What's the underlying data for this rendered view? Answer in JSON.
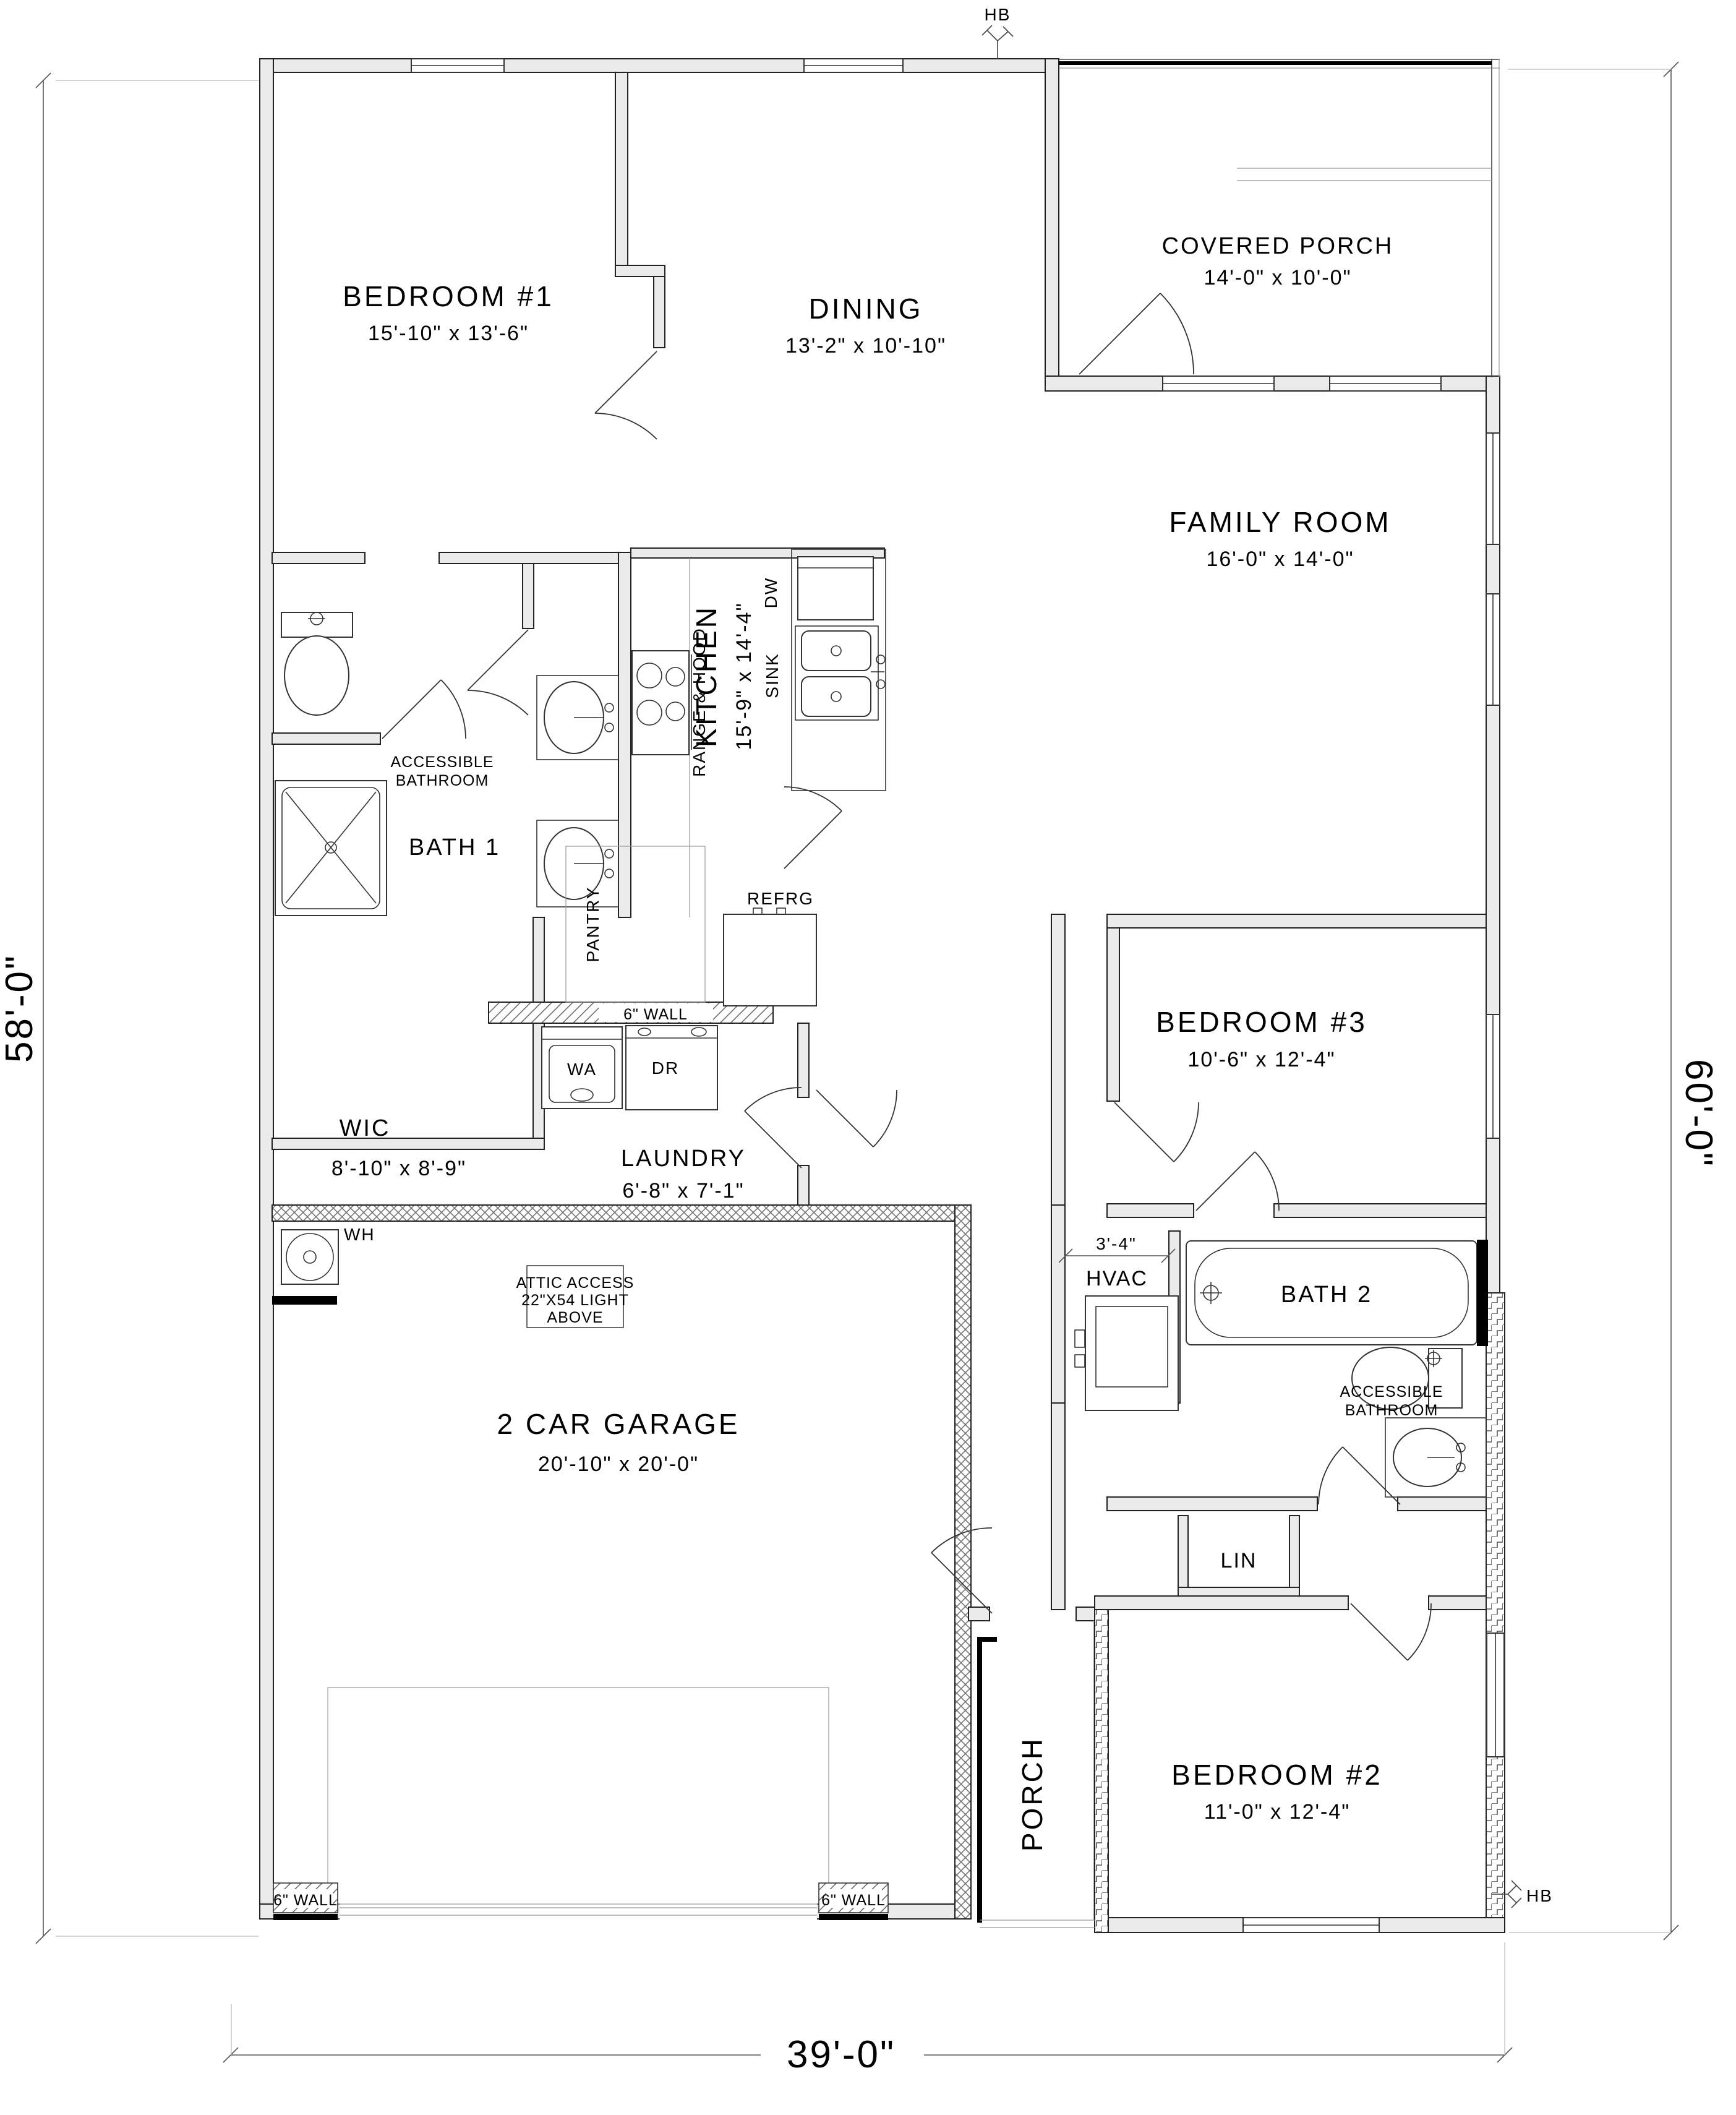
{
  "dims": {
    "left": "58'-0\"",
    "right": "60'-0\"",
    "bottom": "39'-0\"",
    "hvac": "3'-4\""
  },
  "hb": {
    "top": "HB",
    "bottom": "HB"
  },
  "rooms": {
    "bedroom1": {
      "name": "BEDROOM #1",
      "size": "15'-10\" x 13'-6\""
    },
    "dining": {
      "name": "DINING",
      "size": "13'-2\" x 10'-10\""
    },
    "covered_porch": {
      "name": "COVERED PORCH",
      "size": "14'-0\" x 10'-0\""
    },
    "family": {
      "name": "FAMILY ROOM",
      "size": "16'-0\" x 14'-0\""
    },
    "kitchen": {
      "name": "KITCHEN",
      "size": "15'-9\" x 14'-4\""
    },
    "bath1": {
      "name": "BATH 1",
      "note1": "ACCESSIBLE",
      "note2": "BATHROOM"
    },
    "wic": {
      "name": "WIC",
      "size": "8'-10\" x 8'-9\""
    },
    "laundry": {
      "name": "LAUNDRY",
      "size": "6'-8\" x 7'-1\""
    },
    "garage": {
      "name": "2 CAR GARAGE",
      "size": "20'-10\" x 20'-0\""
    },
    "bedroom3": {
      "name": "BEDROOM #3",
      "size": "10'-6\" x 12'-4\""
    },
    "hvac": {
      "name": "HVAC"
    },
    "bath2": {
      "name": "BATH 2",
      "note1": "ACCESSIBLE",
      "note2": "BATHROOM"
    },
    "lin": {
      "name": "LIN"
    },
    "porch": {
      "name": "PORCH"
    },
    "bedroom2": {
      "name": "BEDROOM #2",
      "size": "11'-0\" x 12'-4\""
    }
  },
  "labels": {
    "range": "RANGE & HOOD",
    "dw": "DW",
    "sink": "SINK",
    "pantry": "PANTRY",
    "refrg": "REFRG",
    "washer": "WA",
    "dryer": "DR",
    "water_heater": "WH",
    "attic1": "ATTIC ACCESS",
    "attic2": "22\"X54 LIGHT",
    "attic3": "ABOVE",
    "wall6": "6\" WALL"
  }
}
